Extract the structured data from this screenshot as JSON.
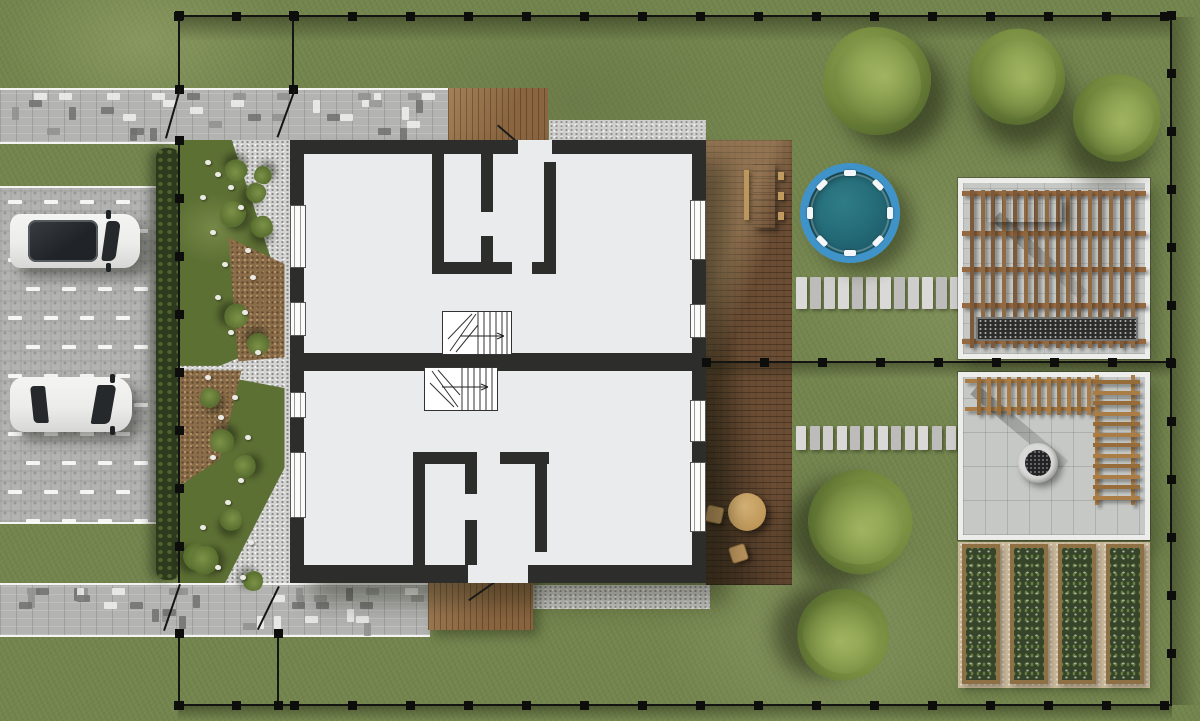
{
  "scene": {
    "label": "Top-view residential site plan: semi-detached two-unit house with driveway, pool, deck, pergola patios and vegetable garden",
    "palette": {
      "grass": "#74854e",
      "pavement": "#b3b3b1",
      "paver_light": "#efefed",
      "paver_dark": "#6f6f6d",
      "gravel": "#d4d4d2",
      "mulch": "#8b6e49",
      "wall": "#2d2d2b",
      "floor": "#e9ebec",
      "deck_wood": "#6b4d34",
      "porch_wood": "#8a6540",
      "light_wood": "#c9a36b",
      "pergola_upper": "#8f6a42",
      "pergola_lower": "#aa7d46",
      "pool_rim": "#3f93c9",
      "pool_water": "#23606c",
      "patio_paver": "#c6c8c6",
      "soil": "#36452a",
      "bed_frame": "#8d7144",
      "sand": "#c9b89a",
      "fence": "#141412",
      "hedge": "#2e3a1e",
      "car_body": "#ececea",
      "car_glass": "#26292c",
      "white_edge": "#f4f4f2"
    },
    "inventory": {
      "house_units": 2,
      "stair_flights": 2,
      "entry_porches": 2,
      "windows": 8,
      "cars": 2,
      "pool": 1,
      "pool_ladder_ticks": 8,
      "deck": 1,
      "dining_set": 1,
      "round_table_set": 1,
      "pergola_patios": 2,
      "pergola_table": 1,
      "grill_bed": 1,
      "fire_pit": 1,
      "garden_beds": 4,
      "stepping_stone_paths": 2,
      "stones_per_path": 12,
      "large_trees": 5,
      "shrubs": 14,
      "fence_gates": 4,
      "fence_post_spacing_px": 58
    }
  }
}
